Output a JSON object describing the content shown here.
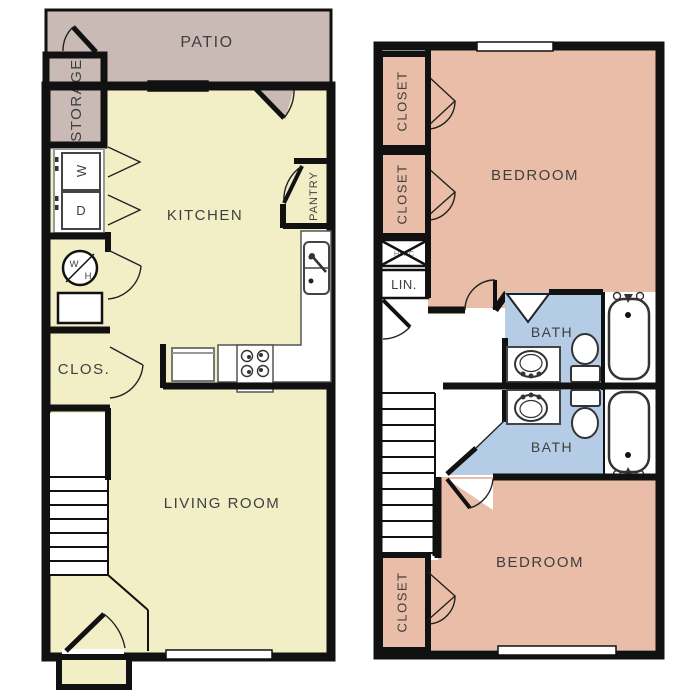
{
  "title": "Two-level townhome floor plan",
  "colors": {
    "patio": "#c9bab5",
    "interior_yellow": "#f2efc7",
    "bedroom_salmon": "#e9bda7",
    "bath_blue": "#b5cce6",
    "wall": "#111111",
    "label_text": "#3f3f3f",
    "fixture_outline": "#444444"
  },
  "floor1": {
    "patio": "PATIO",
    "storage": "STORAGE",
    "kitchen": "KITCHEN",
    "pantry": "PANTRY",
    "washer": "W",
    "dryer": "D",
    "water_heater_w": "W",
    "water_heater_h": "H",
    "closet": "CLOS.",
    "living_room": "LIVING ROOM"
  },
  "floor2": {
    "closet_top": "CLOSET",
    "closet_mid": "CLOSET",
    "bedroom_top": "BEDROOM",
    "hvac": "HVAC",
    "linen": "LIN.",
    "bath_top": "BATH",
    "bath_bottom": "BATH",
    "bedroom_bottom": "BEDROOM",
    "closet_bottom": "CLOSET"
  }
}
